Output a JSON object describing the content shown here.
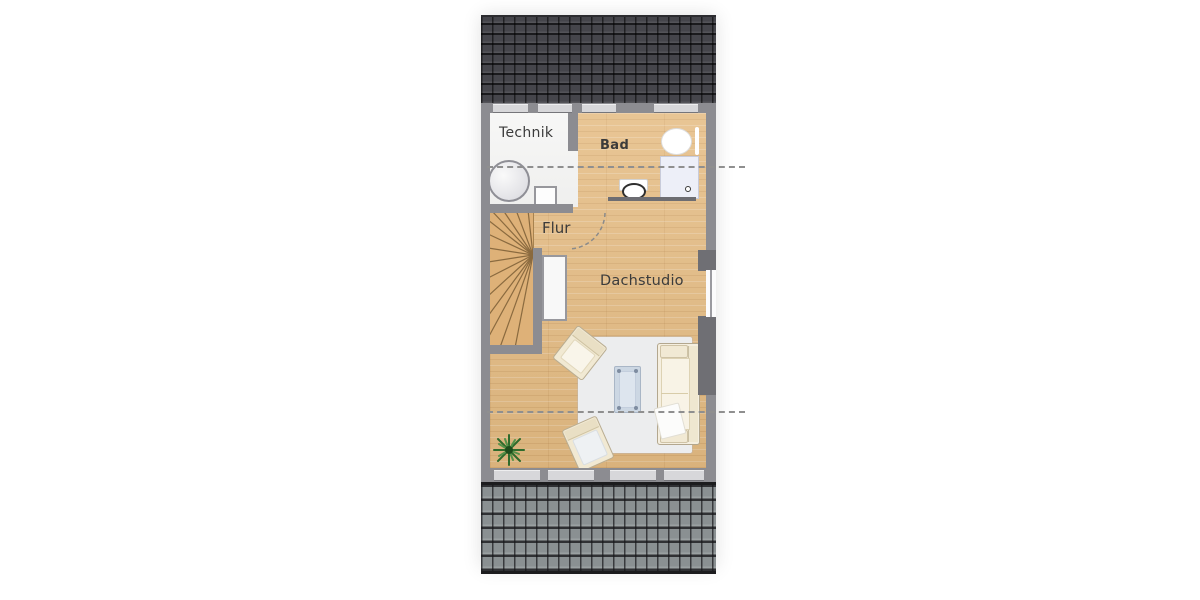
{
  "floorplan": {
    "type": "attic-storey-floor-plan",
    "rooms": [
      {
        "id": "technik",
        "label": "Technik"
      },
      {
        "id": "bad",
        "label": "Bad"
      },
      {
        "id": "flur",
        "label": "Flur"
      },
      {
        "id": "dachstudio",
        "label": "Dachstudio"
      }
    ],
    "fixtures": [
      "winder-staircase",
      "water-tank",
      "equipment-box",
      "washbasin",
      "shower",
      "toilet",
      "door-swing",
      "sofa",
      "armchair-top",
      "armchair-bottom",
      "coffee-table",
      "rug",
      "potted-plant"
    ],
    "colors": {
      "wood_floor": "#e5bc83",
      "wall": "#8c8c91",
      "roof_dark": "#45454b",
      "roof_light": "#8a9092",
      "technik_floor": "#f5f5f4",
      "rug": "#ecedee",
      "sofa": "#f5efe0",
      "coffee_table": "#ccd7e3",
      "section_line": "#8f8f8f",
      "label_text": "#3b3b3b"
    },
    "section_lines": {
      "count": 2,
      "style": "dashed"
    }
  }
}
